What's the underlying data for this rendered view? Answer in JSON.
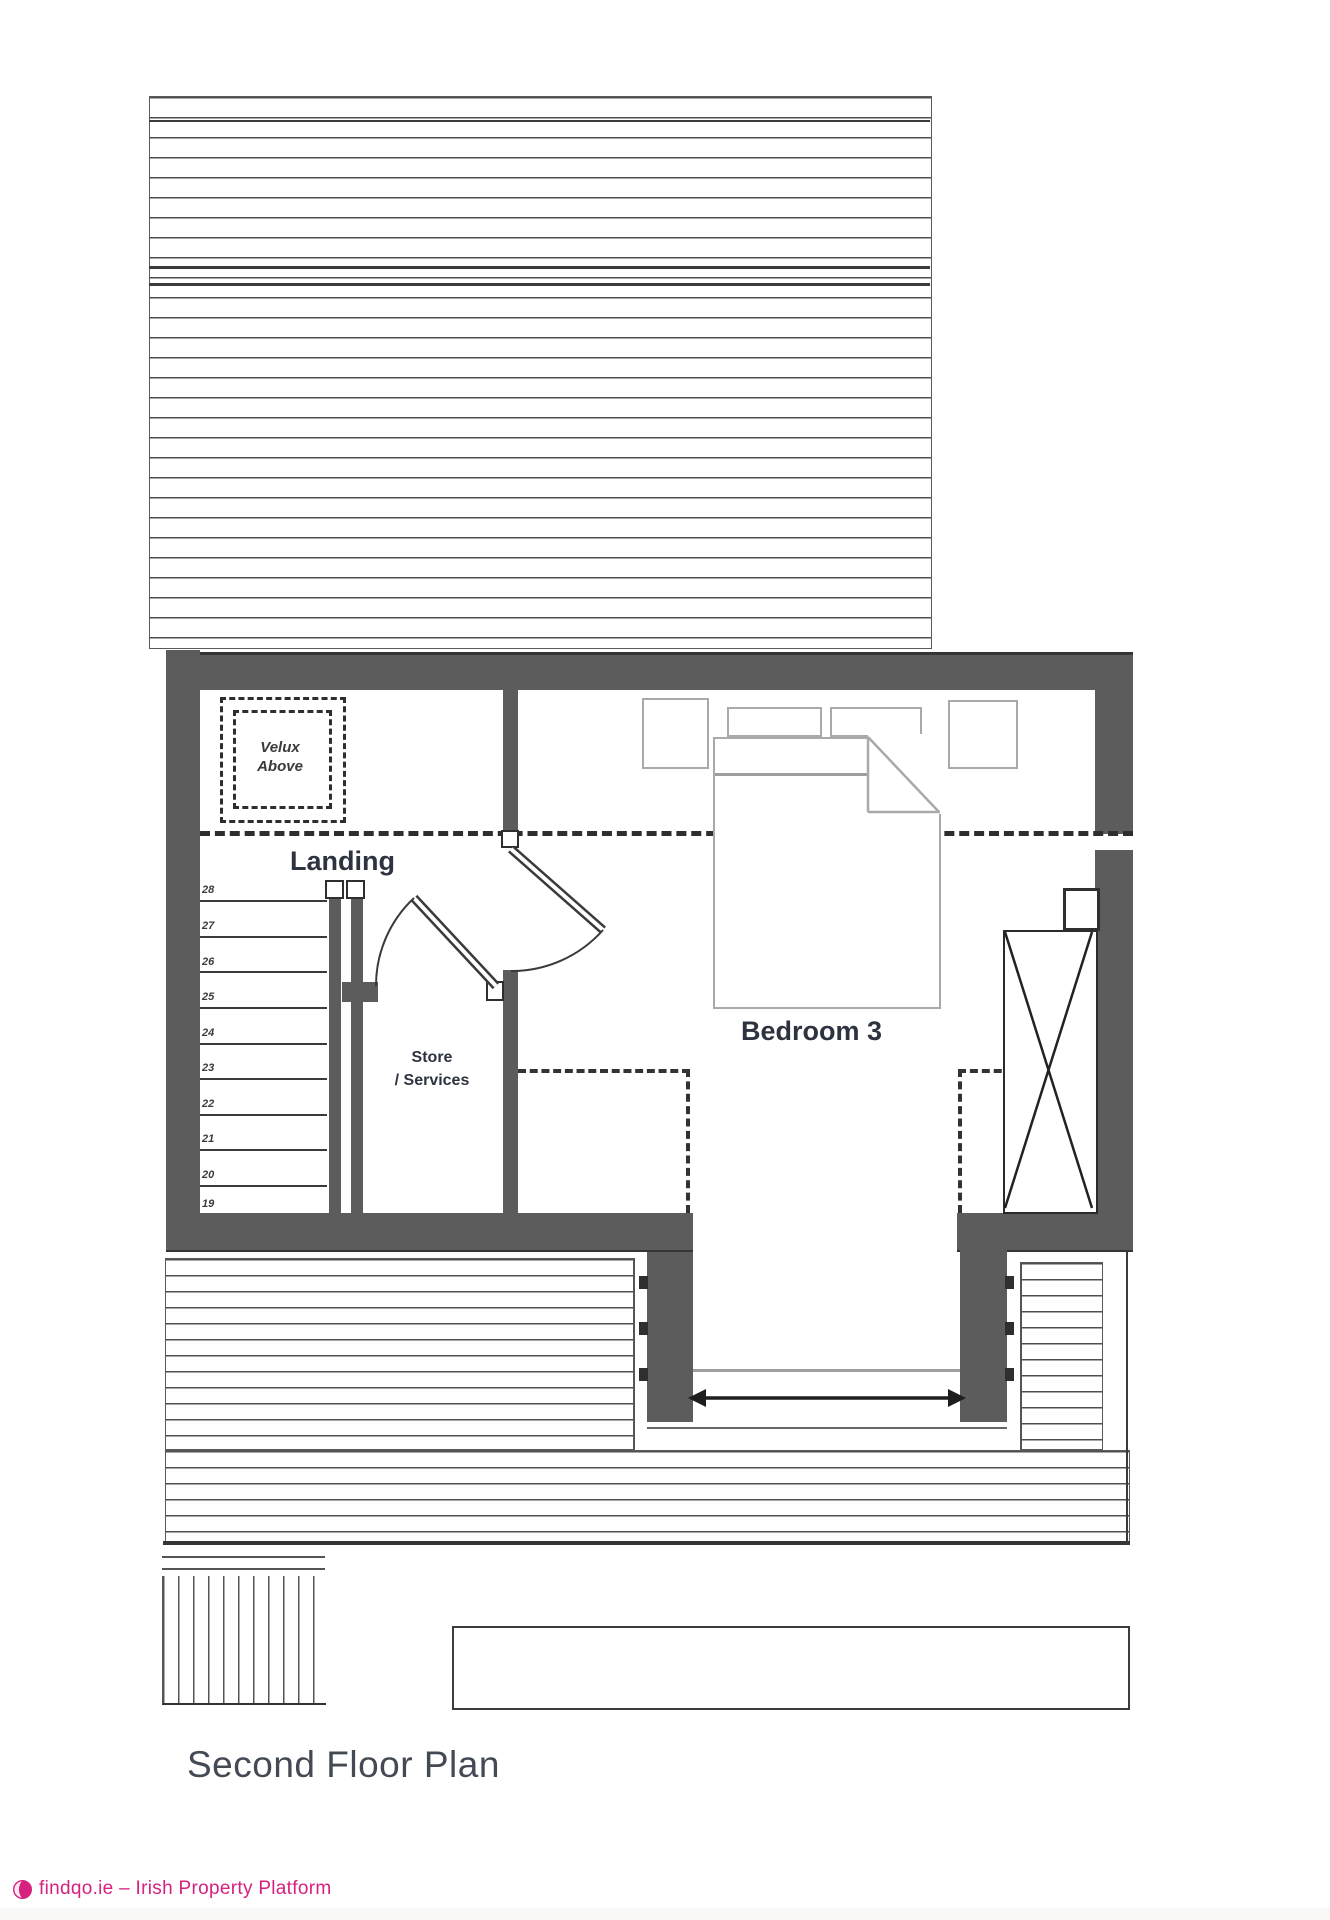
{
  "title": "Second Floor Plan",
  "rooms": {
    "landing": "Landing",
    "bedroom": "Bedroom 3",
    "store_line1": "Store",
    "store_line2": "/ Services"
  },
  "velux": {
    "line1": "Velux",
    "line2": "Above"
  },
  "stairs": {
    "numbers": [
      "28",
      "27",
      "26",
      "25",
      "24",
      "23",
      "22",
      "21",
      "20",
      "19"
    ]
  },
  "footer": {
    "text": "findqo.ie – Irish Property Platform",
    "brand_color": "#d6217f"
  },
  "colors": {
    "wall": "#5c5c5c",
    "drawing_line": "#3a3a3a",
    "furniture_line": "#a9a9a9",
    "label_text": "#2d3440",
    "title_text": "#434a54"
  }
}
